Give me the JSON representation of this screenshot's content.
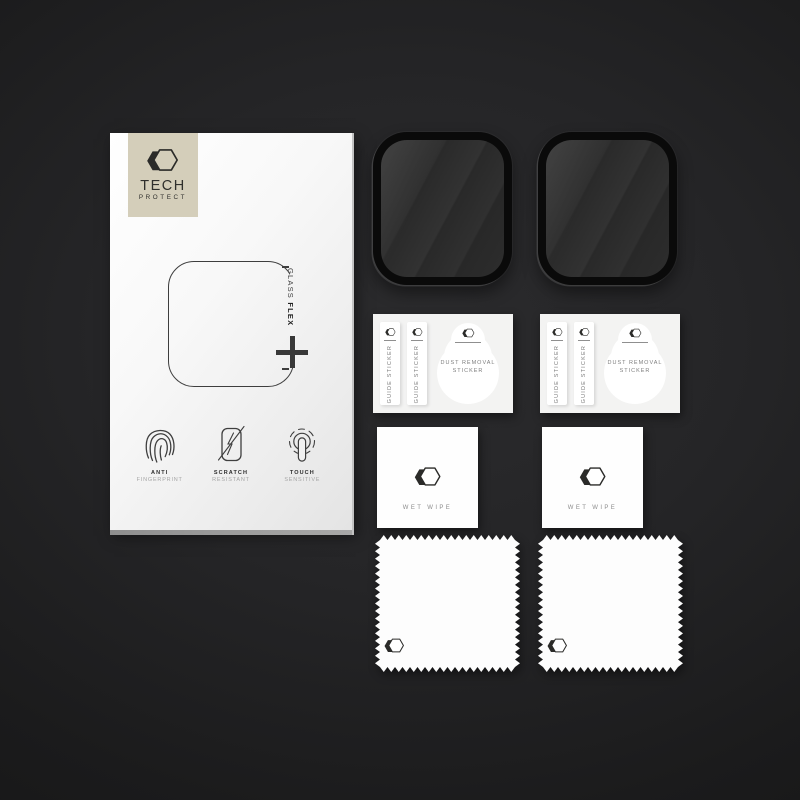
{
  "scene": {
    "type": "product-photo",
    "background_center": "#2a2a2c",
    "background_edge": "#141415"
  },
  "box": {
    "brand": {
      "name_line1": "TECH",
      "name_line2": "PROTECT",
      "logo_icon": "double-hexagon-icon",
      "logo_bg": "#d4ceba"
    },
    "glass_label": {
      "word1": "GLASS",
      "word2": "FLEX",
      "plus_icon": "plus-icon"
    },
    "features": [
      {
        "icon": "fingerprint-icon",
        "title": "ANTI",
        "subtitle": "FINGERPRINT"
      },
      {
        "icon": "scratch-resistant-icon",
        "title": "SCRATCH",
        "subtitle": "RESISTANT"
      },
      {
        "icon": "touch-sensitive-icon",
        "title": "TOUCH",
        "subtitle": "SENSITIVE"
      }
    ]
  },
  "kit": {
    "screen_protector_count": 2,
    "guide_sticker_label": "GUIDE STICKER",
    "dust_removal_line1": "DUST REMOVAL",
    "dust_removal_line2": "STICKER",
    "wet_wipe_label": "WET WIPE",
    "cloth_count": 2
  },
  "colors": {
    "protector_frame": "#0a0a0a",
    "protector_glass": "#303030",
    "card_bg": "#f3f3f2",
    "box_face": "#f7f7f7"
  }
}
